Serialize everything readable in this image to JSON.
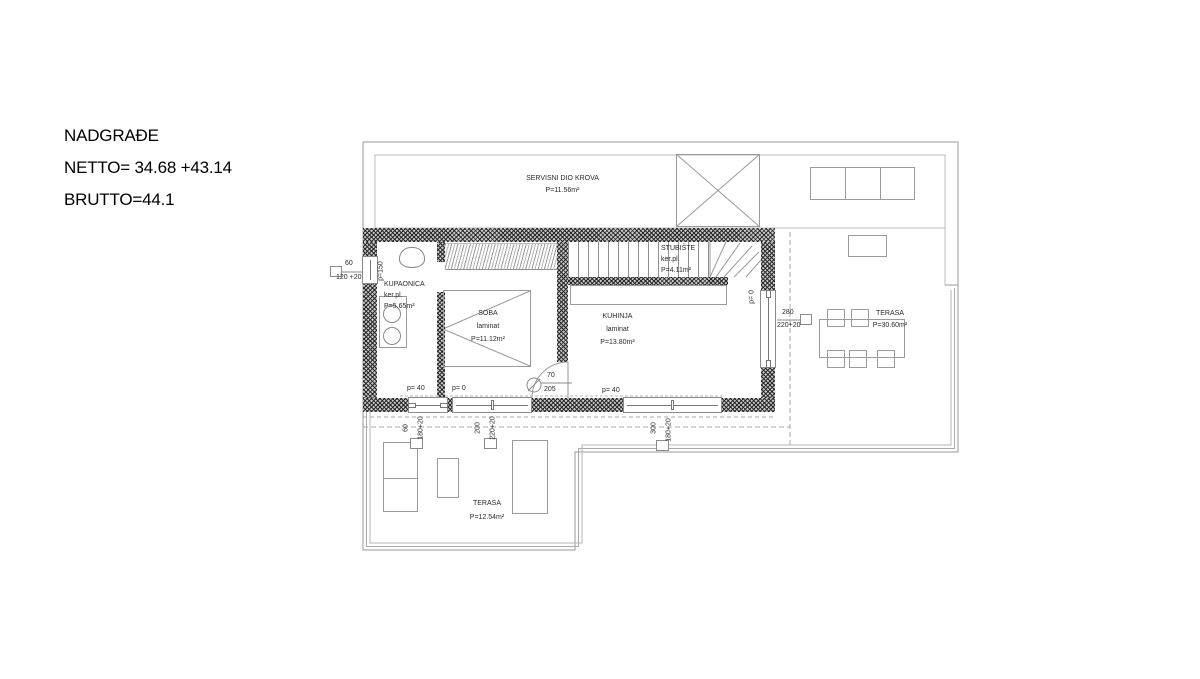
{
  "title": {
    "project": "NADGRAĐE",
    "netto": "NETTO= 34.68 +43.14",
    "brutto": "BRUTTO=44.1"
  },
  "rooms": {
    "servisni": {
      "name": "SERVISNI DIO KROVA",
      "area": "P=11.56m²"
    },
    "stubiste": {
      "name": "STUBIŠTE",
      "finish": "ker.pl.",
      "area": "P=4.11m²"
    },
    "kupaonica": {
      "name": "KUPAONICA",
      "finish": "ker.pl.",
      "area": "P=5.65m²"
    },
    "soba": {
      "name": "SOBA",
      "finish": "laminat",
      "area": "P=11.12m²"
    },
    "kuhinja": {
      "name": "KUHINJA",
      "finish": "laminat",
      "area": "P=13.80m²"
    },
    "terasa_gornja": {
      "name": "TERASA",
      "area": "P=30.60m²"
    },
    "terasa_donja": {
      "name": "TERASA",
      "area": "P=12.54m²"
    }
  },
  "openings": {
    "left_window": {
      "width": "60",
      "height": "120 +20",
      "parapet": "p=150"
    },
    "window1": {
      "parapet": "p= 40",
      "width": "60",
      "height": "180+20"
    },
    "window2": {
      "parapet": "p= 0",
      "width": "200",
      "height": "220+20"
    },
    "window3": {
      "parapet": "p= 40",
      "width": "300",
      "height": "180+20"
    },
    "right_door": {
      "parapet": "p= 0",
      "width": "280",
      "height": "220+20"
    },
    "interior_door": {
      "width": "70",
      "height": "205"
    }
  },
  "colors": {
    "wall_hatch": "#2a2a2a",
    "thin_line": "#9a9a9a",
    "text": "#2a2a2a"
  }
}
